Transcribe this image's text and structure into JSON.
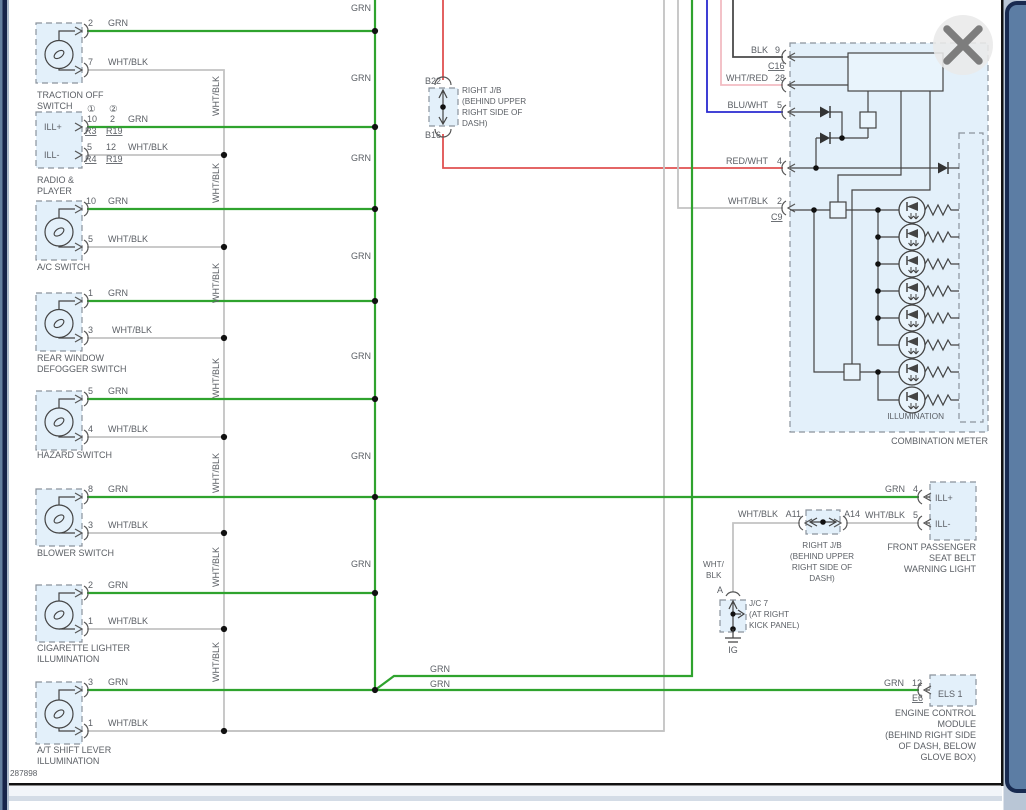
{
  "page": {
    "diagram_id": "287898"
  },
  "wire_labels": {
    "grn": "GRN",
    "wht_blk": "WHT/BLK"
  },
  "grn_bus_labels": [
    "GRN",
    "GRN",
    "GRN",
    "GRN",
    "GRN",
    "GRN",
    "GRN"
  ],
  "whtblk_bus_labels": [
    "WHT/BLK",
    "WHT/BLK",
    "WHT/BLK",
    "WHT/BLK",
    "WHT/BLK",
    "WHT/BLK",
    "WHT/BLK"
  ],
  "grn_branch_labels": [
    "GRN",
    "GRN"
  ],
  "switches": [
    {
      "grn_pin": "2",
      "wht_pin": "7",
      "name_lines": [
        "TRACTION OFF",
        "SWITCH"
      ]
    },
    {
      "grn_pin": "10",
      "wht_pin": "5",
      "name_lines": [
        "A/C SWITCH"
      ]
    },
    {
      "grn_pin": "1",
      "wht_pin": "3",
      "name_lines": [
        "REAR WINDOW",
        "DEFOGGER SWITCH"
      ]
    },
    {
      "grn_pin": "5",
      "wht_pin": "4",
      "name_lines": [
        "HAZARD SWITCH"
      ]
    },
    {
      "grn_pin": "8",
      "wht_pin": "3",
      "name_lines": [
        "BLOWER SWITCH"
      ]
    },
    {
      "grn_pin": "2",
      "wht_pin": "1",
      "name_lines": [
        "CIGARETTE LIGHTER",
        "ILLUMINATION"
      ]
    },
    {
      "grn_pin": "3",
      "wht_pin": "1",
      "name_lines": [
        "A/T SHIFT LEVER",
        "ILLUMINATION"
      ]
    }
  ],
  "radio": {
    "name_lines": [
      "RADIO &",
      "PLAYER"
    ],
    "ill_plus": "ILL+",
    "ill_minus": "ILL-",
    "col1": "①",
    "col2": "②",
    "row1": {
      "p1": "10",
      "p2": "2",
      "color": "GRN",
      "r1": "R3",
      "r2": "R19"
    },
    "row2": {
      "p1": "5",
      "p2": "12",
      "color": "WHT/BLK",
      "r1": "R4",
      "r2": "R19"
    }
  },
  "mid_jb": {
    "top_conn": "B22",
    "bottom_conn": "B16",
    "name_lines": [
      "RIGHT J/B",
      "(BEHIND UPPER",
      "RIGHT SIDE OF",
      "DASH)"
    ]
  },
  "meter": {
    "pins": [
      {
        "label": "BLK",
        "num": "9",
        "ref": "C16"
      },
      {
        "label": "WHT/RED",
        "num": "28",
        "ref": ""
      },
      {
        "label": "BLU/WHT",
        "num": "5",
        "ref": ""
      },
      {
        "label": "RED/WHT",
        "num": "4",
        "ref": ""
      },
      {
        "label": "WHT/BLK",
        "num": "2",
        "ref": "C9"
      }
    ],
    "illumination": "ILLUMINATION",
    "name": "COMBINATION METER"
  },
  "seatbelt": {
    "grn": "GRN",
    "grn_pin": "4",
    "wht": "WHT/BLK",
    "wht_pin": "5",
    "ill_plus": "ILL+",
    "ill_minus": "ILL-",
    "name_lines": [
      "FRONT PASSENGER",
      "SEAT BELT",
      "WARNING LIGHT"
    ]
  },
  "right_jb": {
    "left_conn": "A11",
    "right_conn": "A14",
    "wire": "WHT/BLK",
    "name_lines": [
      "RIGHT J/B",
      "(BEHIND UPPER",
      "RIGHT SIDE OF",
      "DASH)"
    ]
  },
  "jc7": {
    "conn": "A",
    "wire_lines": [
      "WHT/",
      "BLK"
    ],
    "ground": "IG",
    "name_lines": [
      "J/C 7",
      "(AT RIGHT",
      "KICK PANEL)"
    ]
  },
  "ecm": {
    "wire": "GRN",
    "pin": "12",
    "ref": "E6",
    "terminal": "ELS 1",
    "name_lines": [
      "ENGINE CONTROL",
      "MODULE",
      "(BEHIND RIGHT SIDE",
      "OF DASH, BELOW",
      "GLOVE BOX)"
    ]
  }
}
